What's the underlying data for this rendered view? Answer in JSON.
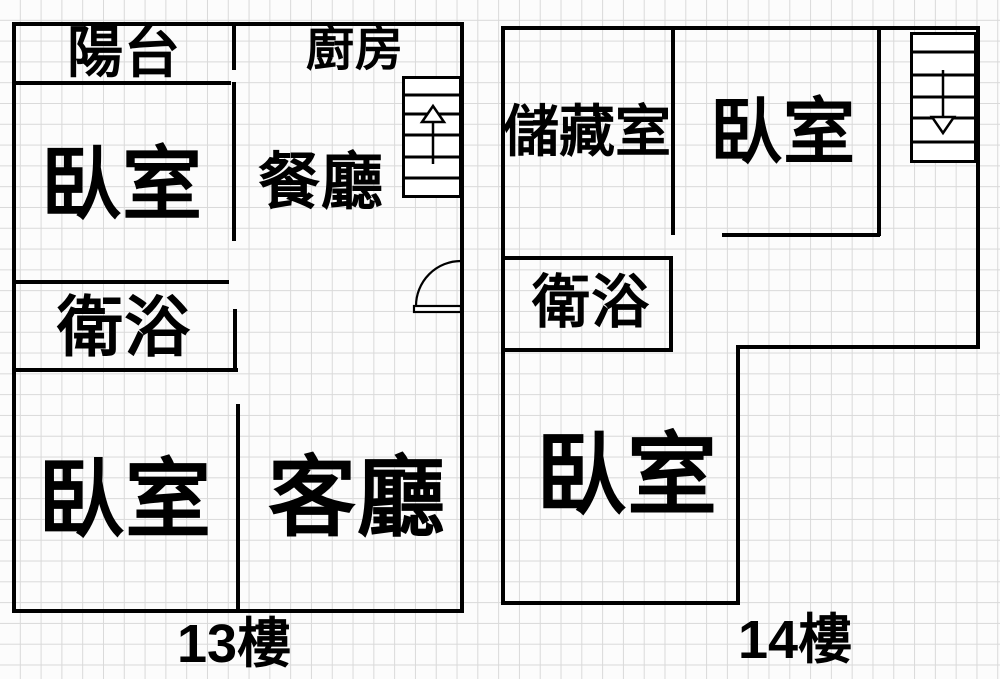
{
  "colors": {
    "wall": "#000000",
    "grid": "#d9d9d9",
    "background": "#fcfcfc",
    "text": "#000000"
  },
  "floor13": {
    "floor_number": "13",
    "floor_suffix": "樓",
    "rooms": {
      "balcony": "陽台",
      "kitchen": "廚房",
      "bedroom_upper": "臥室",
      "dining": "餐廳",
      "bathroom": "衛浴",
      "bedroom_lower": "臥室",
      "living": "客廳"
    },
    "stairs_icon": "up-arrow"
  },
  "floor14": {
    "floor_number": "14",
    "floor_suffix": "樓",
    "rooms": {
      "storage": "儲藏室",
      "bedroom_upper": "臥室",
      "bathroom": "衛浴",
      "bedroom_lower": "臥室"
    },
    "stairs_icon": "down-arrow"
  },
  "icons": {
    "door": "quarter-arc-door-swing",
    "stairs_up": "up-arrow",
    "stairs_down": "down-arrow"
  }
}
